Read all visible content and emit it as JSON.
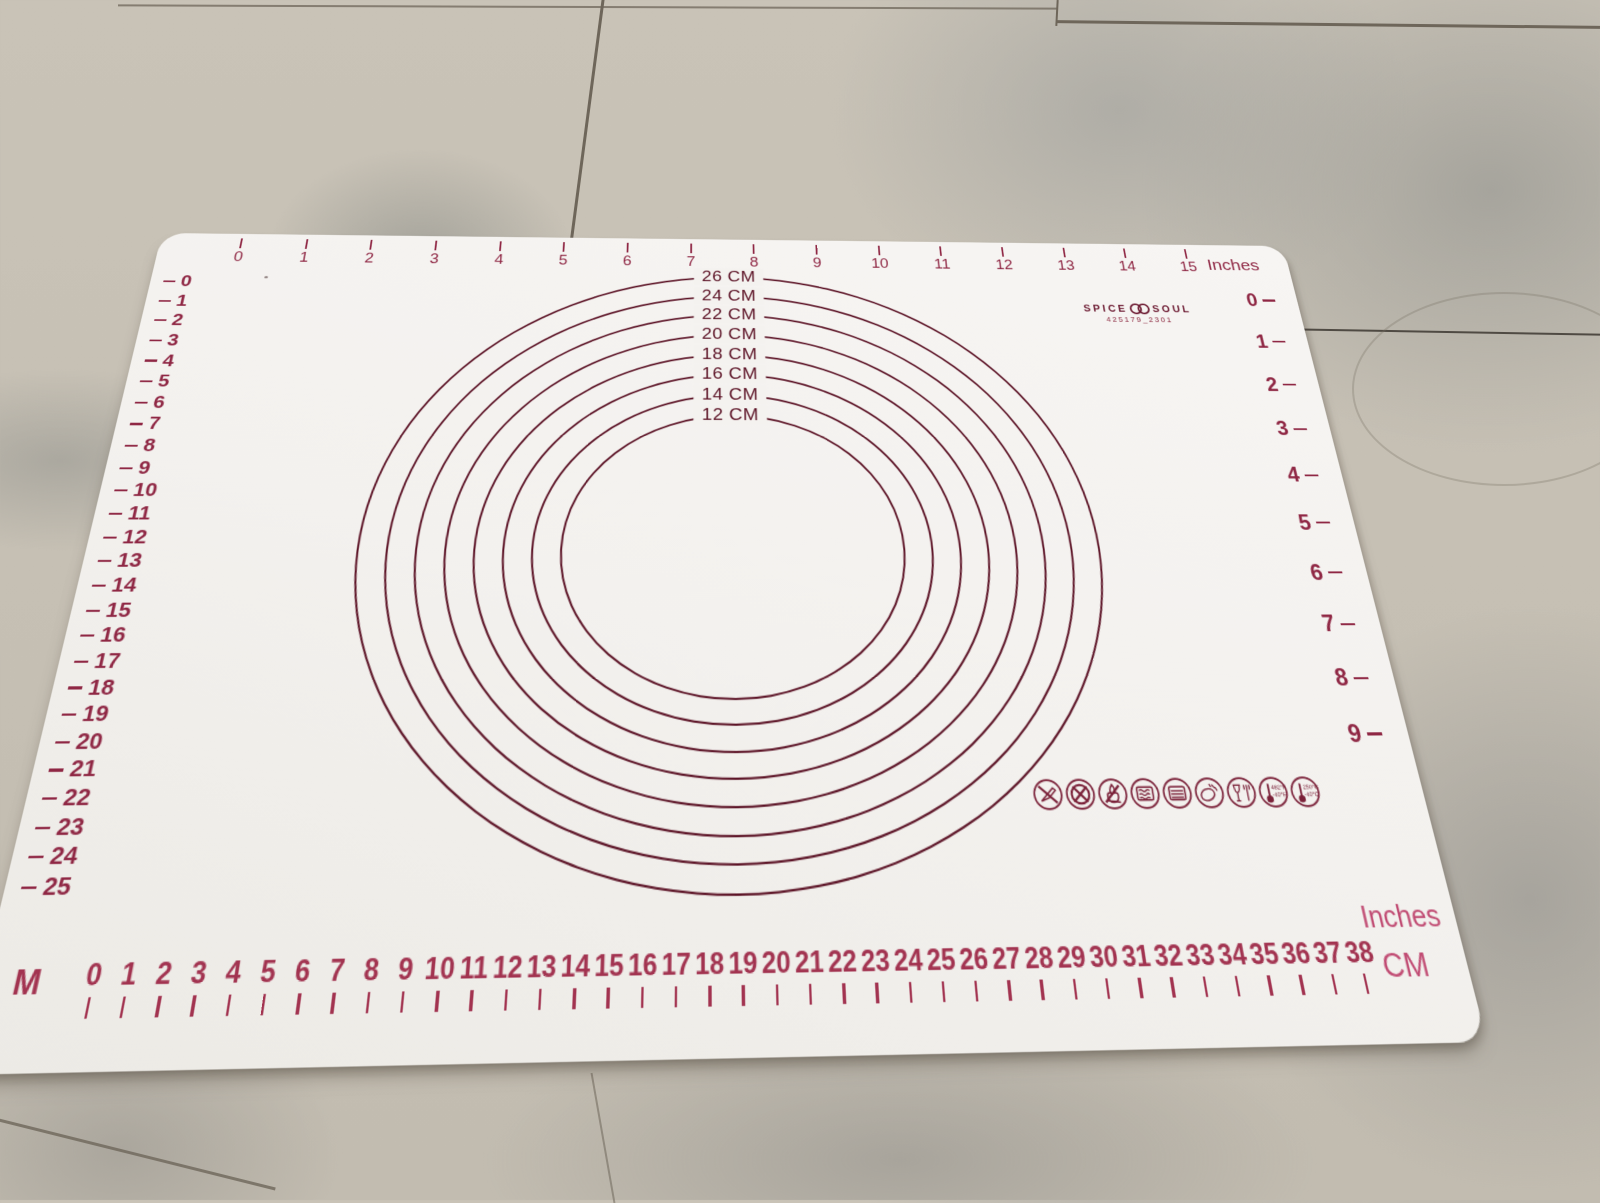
{
  "colors": {
    "print_dark": "#5c1326",
    "print_red": "#8f2744",
    "print_crimson": "#a23350",
    "print_pink": "#c04a72",
    "mat_white": "#f4f2ee",
    "floor_beige": "#c9c3b7",
    "grout": "#6e665a"
  },
  "mat": {
    "brand": {
      "word_left": "SPICE",
      "word_right": "SOUL",
      "logo_icon": "double-ring-icon",
      "code": "425179_2301"
    },
    "circles": [
      {
        "diameter_cm": 26,
        "label": "26 CM"
      },
      {
        "diameter_cm": 24,
        "label": "24 CM"
      },
      {
        "diameter_cm": 22,
        "label": "22 CM"
      },
      {
        "diameter_cm": 20,
        "label": "20 CM"
      },
      {
        "diameter_cm": 18,
        "label": "18 CM"
      },
      {
        "diameter_cm": 16,
        "label": "16 CM"
      },
      {
        "diameter_cm": 14,
        "label": "14 CM"
      },
      {
        "diameter_cm": 12,
        "label": "12 CM"
      }
    ],
    "rulers": {
      "top": {
        "unit_label": "Inches",
        "ticks": [
          "0",
          "1",
          "2",
          "3",
          "4",
          "5",
          "6",
          "7",
          "8",
          "9",
          "10",
          "11",
          "12",
          "13",
          "14",
          "15"
        ]
      },
      "left": {
        "ticks": [
          "0",
          "1",
          "2",
          "3",
          "4",
          "5",
          "6",
          "7",
          "8",
          "9",
          "10",
          "11",
          "12",
          "13",
          "14",
          "15",
          "16",
          "17",
          "18",
          "19",
          "20",
          "21",
          "22",
          "23",
          "24",
          "25"
        ]
      },
      "right": {
        "ticks": [
          "0",
          "1",
          "2",
          "3",
          "4",
          "5",
          "6",
          "7",
          "8",
          "9"
        ]
      },
      "bottom": {
        "corner_label": "M",
        "unit_label_inches": "Inches",
        "unit_label_cm": "CM",
        "ticks": [
          "0",
          "1",
          "2",
          "3",
          "4",
          "5",
          "6",
          "7",
          "8",
          "9",
          "10",
          "11",
          "12",
          "13",
          "14",
          "15",
          "16",
          "17",
          "18",
          "19",
          "20",
          "21",
          "22",
          "23",
          "24",
          "25",
          "26",
          "27",
          "28",
          "29",
          "30",
          "31",
          "32",
          "33",
          "34",
          "35",
          "36",
          "37",
          "38"
        ]
      }
    },
    "care_icons": [
      {
        "name": "no-knife-icon"
      },
      {
        "name": "no-sharp-objects-icon"
      },
      {
        "name": "no-open-flame-icon"
      },
      {
        "name": "microwave-safe-icon"
      },
      {
        "name": "oven-safe-icon"
      },
      {
        "name": "dishwasher-safe-icon"
      },
      {
        "name": "food-safe-icon"
      },
      {
        "name": "temperature-fahrenheit-icon",
        "text_top": "482°F",
        "text_bottom": "-40°F"
      },
      {
        "name": "temperature-celsius-icon",
        "text_top": "250°C",
        "text_bottom": "-40°C"
      }
    ]
  }
}
